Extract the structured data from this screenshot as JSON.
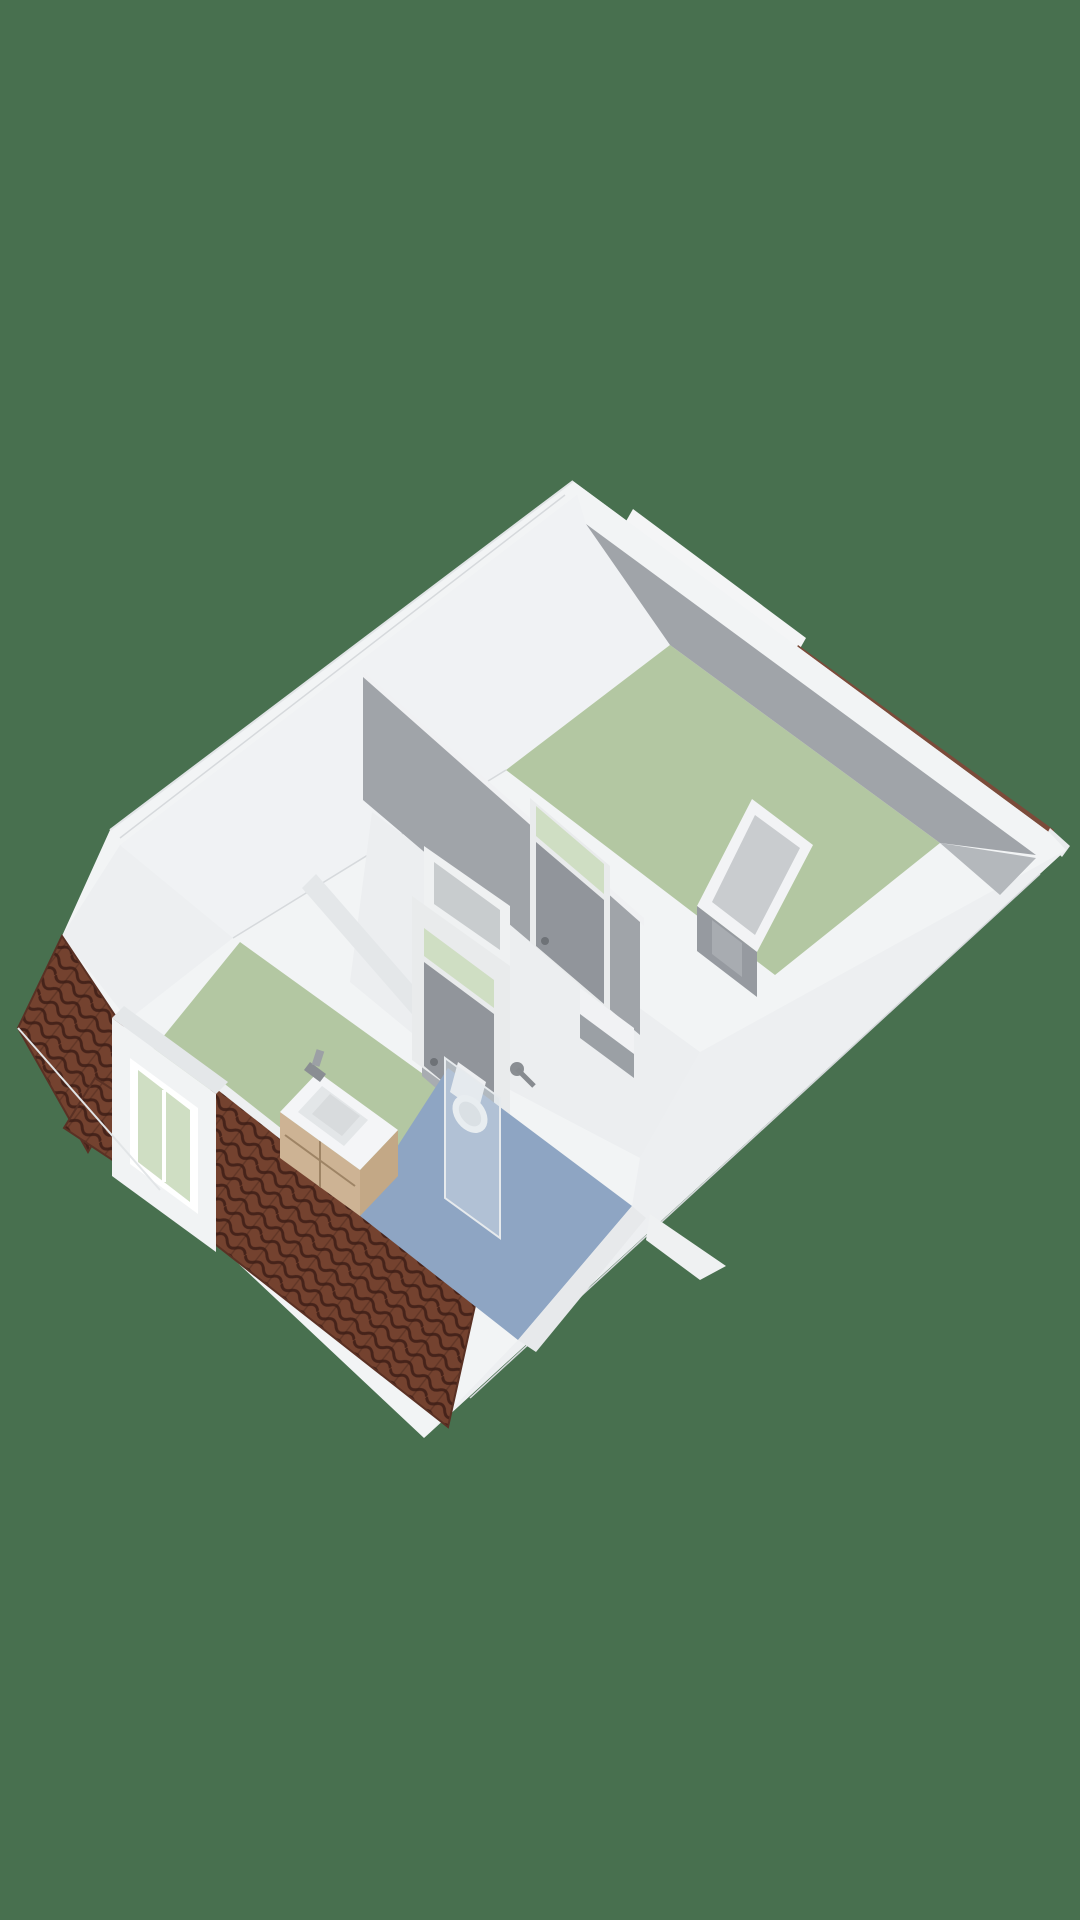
{
  "scene": {
    "title": "3D floor plan — attic storey",
    "projection": "isometric bird's-eye render",
    "rooms": [
      {
        "name": "bedroom-rear",
        "floor": "sage-green"
      },
      {
        "name": "bedroom-front",
        "floor": "sage-green"
      },
      {
        "name": "landing",
        "floor": "white"
      },
      {
        "name": "bathroom",
        "floor": "blue"
      },
      {
        "name": "closet",
        "floor": "grey"
      }
    ],
    "fixtures": [
      "sink-vanity",
      "faucet",
      "toilet",
      "shower-mixer",
      "shower-glass-panel"
    ],
    "features": [
      "dormer-window",
      "tiled-roof-slopes",
      "transom-windows-above-doors",
      "interior-doors",
      "party-wall-ridge-ledge"
    ]
  },
  "colors": {
    "background": "#48704F",
    "wall_white": "#F2F4F5",
    "band_white": "#EDEFF1",
    "band_shade": "#E4E7E9",
    "wall_grey": "#A0A4A9",
    "wall_grey_dk": "#91959B",
    "floor_sage": "#B3C7A2",
    "floor_sage_lt": "#C9D7BF",
    "floor_blue": "#8EA5C3",
    "floor_hall": "#ECEEF0",
    "floor_closet": "#C9CCCF",
    "roof_tile": "#74422F",
    "roof_tile_dark": "#46231A",
    "roof_edge": "#7B4B3A",
    "glass_green": "#CFDEC3",
    "glass_grey": "#C8CCCE",
    "wood_light": "#CDB394",
    "wood_dark": "#C3A886",
    "metal": "#8A8E93"
  }
}
